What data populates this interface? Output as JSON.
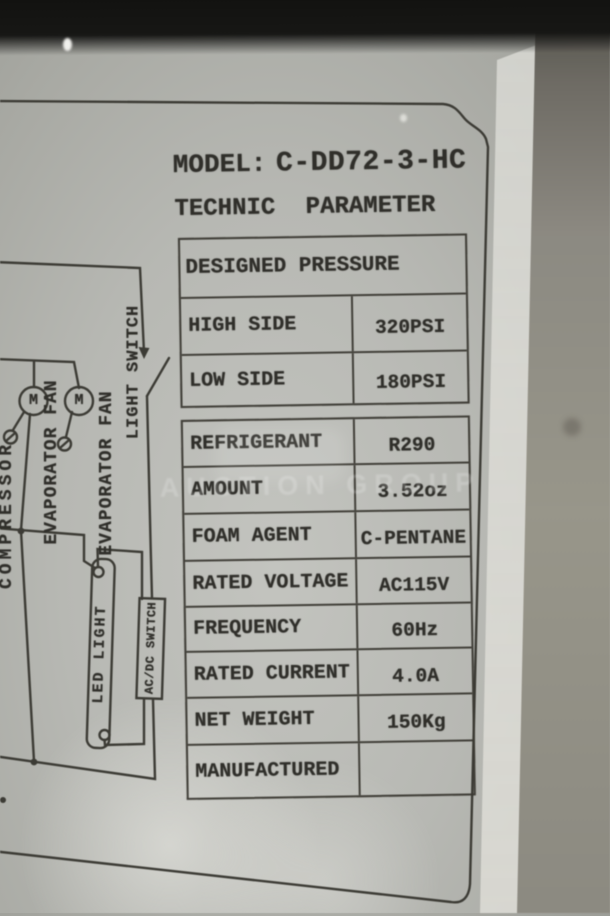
{
  "plate": {
    "model_label": "MODEL:",
    "model_value": "C-DD72-3-HC",
    "subtitle": "TECHNIC PARAMETER"
  },
  "pressure_table": {
    "header": "DESIGNED PRESSURE",
    "rows": [
      {
        "label": "HIGH SIDE",
        "value": "320PSI"
      },
      {
        "label": "LOW SIDE",
        "value": "180PSI"
      }
    ]
  },
  "spec_table": {
    "rows": [
      {
        "label": "REFRIGERANT",
        "value": "R290"
      },
      {
        "label": "AMOUNT",
        "value": "3.52oz"
      },
      {
        "label": "FOAM AGENT",
        "value": "C-PENTANE"
      },
      {
        "label": "RATED VOLTAGE",
        "value": "AC115V"
      },
      {
        "label": "FREQUENCY",
        "value": "60Hz"
      },
      {
        "label": "RATED CURRENT",
        "value": "4.0A"
      },
      {
        "label": "NET WEIGHT",
        "value": "150Kg"
      },
      {
        "label": "MANUFACTURED",
        "value": ""
      }
    ]
  },
  "diagram": {
    "motor_symbol": "M",
    "compressor_label": "COMPRESSOR",
    "fan_labels": [
      "EVAPORATOR FAN",
      "EVAPORATOR FAN"
    ],
    "light_switch_label": "LIGHT SWITCH",
    "led_light_label": "LED LIGHT",
    "acdc_switch_label": "AC/DC SWITCH"
  },
  "watermark": "AUCTION GROUP",
  "colors": {
    "ink": "#2e2d28",
    "sticker": "#b9bab5",
    "background_right": "#8f8c83",
    "background_top": "#131311"
  }
}
